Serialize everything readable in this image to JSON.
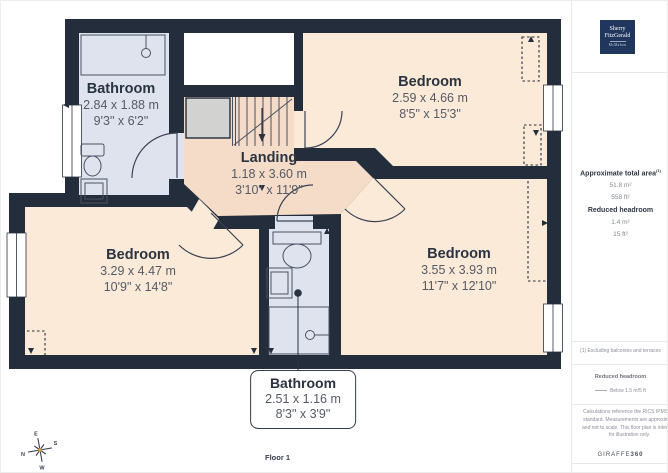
{
  "page": {
    "floor_label": "Floor 1"
  },
  "branding": {
    "logo_line1": "Sherry",
    "logo_line2": "FitzGerald",
    "logo_sub": "McMahon",
    "watermark_name": "GIRAFFE",
    "watermark_number": "360"
  },
  "sidebar": {
    "total_area_label": "Approximate total area",
    "total_area_note_ref": "(1)",
    "total_area_metric": "51.8 m²",
    "total_area_imperial": "558 ft²",
    "headroom_label": "Reduced headroom",
    "headroom_metric": "1.4 m²",
    "headroom_imperial": "15 ft²",
    "footnote": "(1) Excluding balconies and terraces",
    "legend_title": "Reduced headroom",
    "legend_value": "Below 1.5 m/5 ft",
    "disclaimer": "Calculations reference the RICS IPMS 3C standard. Measurements are approximate and not to scale. This floor plan is intended for illustration only."
  },
  "rooms": {
    "bathroom_top_left": {
      "name": "Bathroom",
      "metric": "2.84 x 1.88 m",
      "imperial": "9'3\" x 6'2\""
    },
    "bedroom_top_right": {
      "name": "Bedroom",
      "metric": "2.59 x 4.66 m",
      "imperial": "8'5\" x 15'3\""
    },
    "landing": {
      "name": "Landing",
      "metric": "1.18 x 3.60 m",
      "imperial": "3'10\" x 11'9\""
    },
    "bedroom_bottom_left": {
      "name": "Bedroom",
      "metric": "3.29 x 4.47 m",
      "imperial": "10'9\" x 14'8\""
    },
    "bedroom_bottom_right": {
      "name": "Bedroom",
      "metric": "3.55 x 3.93 m",
      "imperial": "11'7\" x 12'10\""
    },
    "bathroom_bottom": {
      "name": "Bathroom",
      "metric": "2.51 x 1.16 m",
      "imperial": "8'3\" x 3'9\""
    }
  },
  "compass": {
    "north": "N",
    "east": "E",
    "south": "S",
    "west": "W"
  },
  "colors": {
    "wall": "#232d3c",
    "bedroom_fill": "#fcead8",
    "landing_fill": "#f5dcc8",
    "bathroom_fill": "#dfe3ed",
    "stairs_fill": "#d2d2d0",
    "logo_background": "#20365c"
  }
}
